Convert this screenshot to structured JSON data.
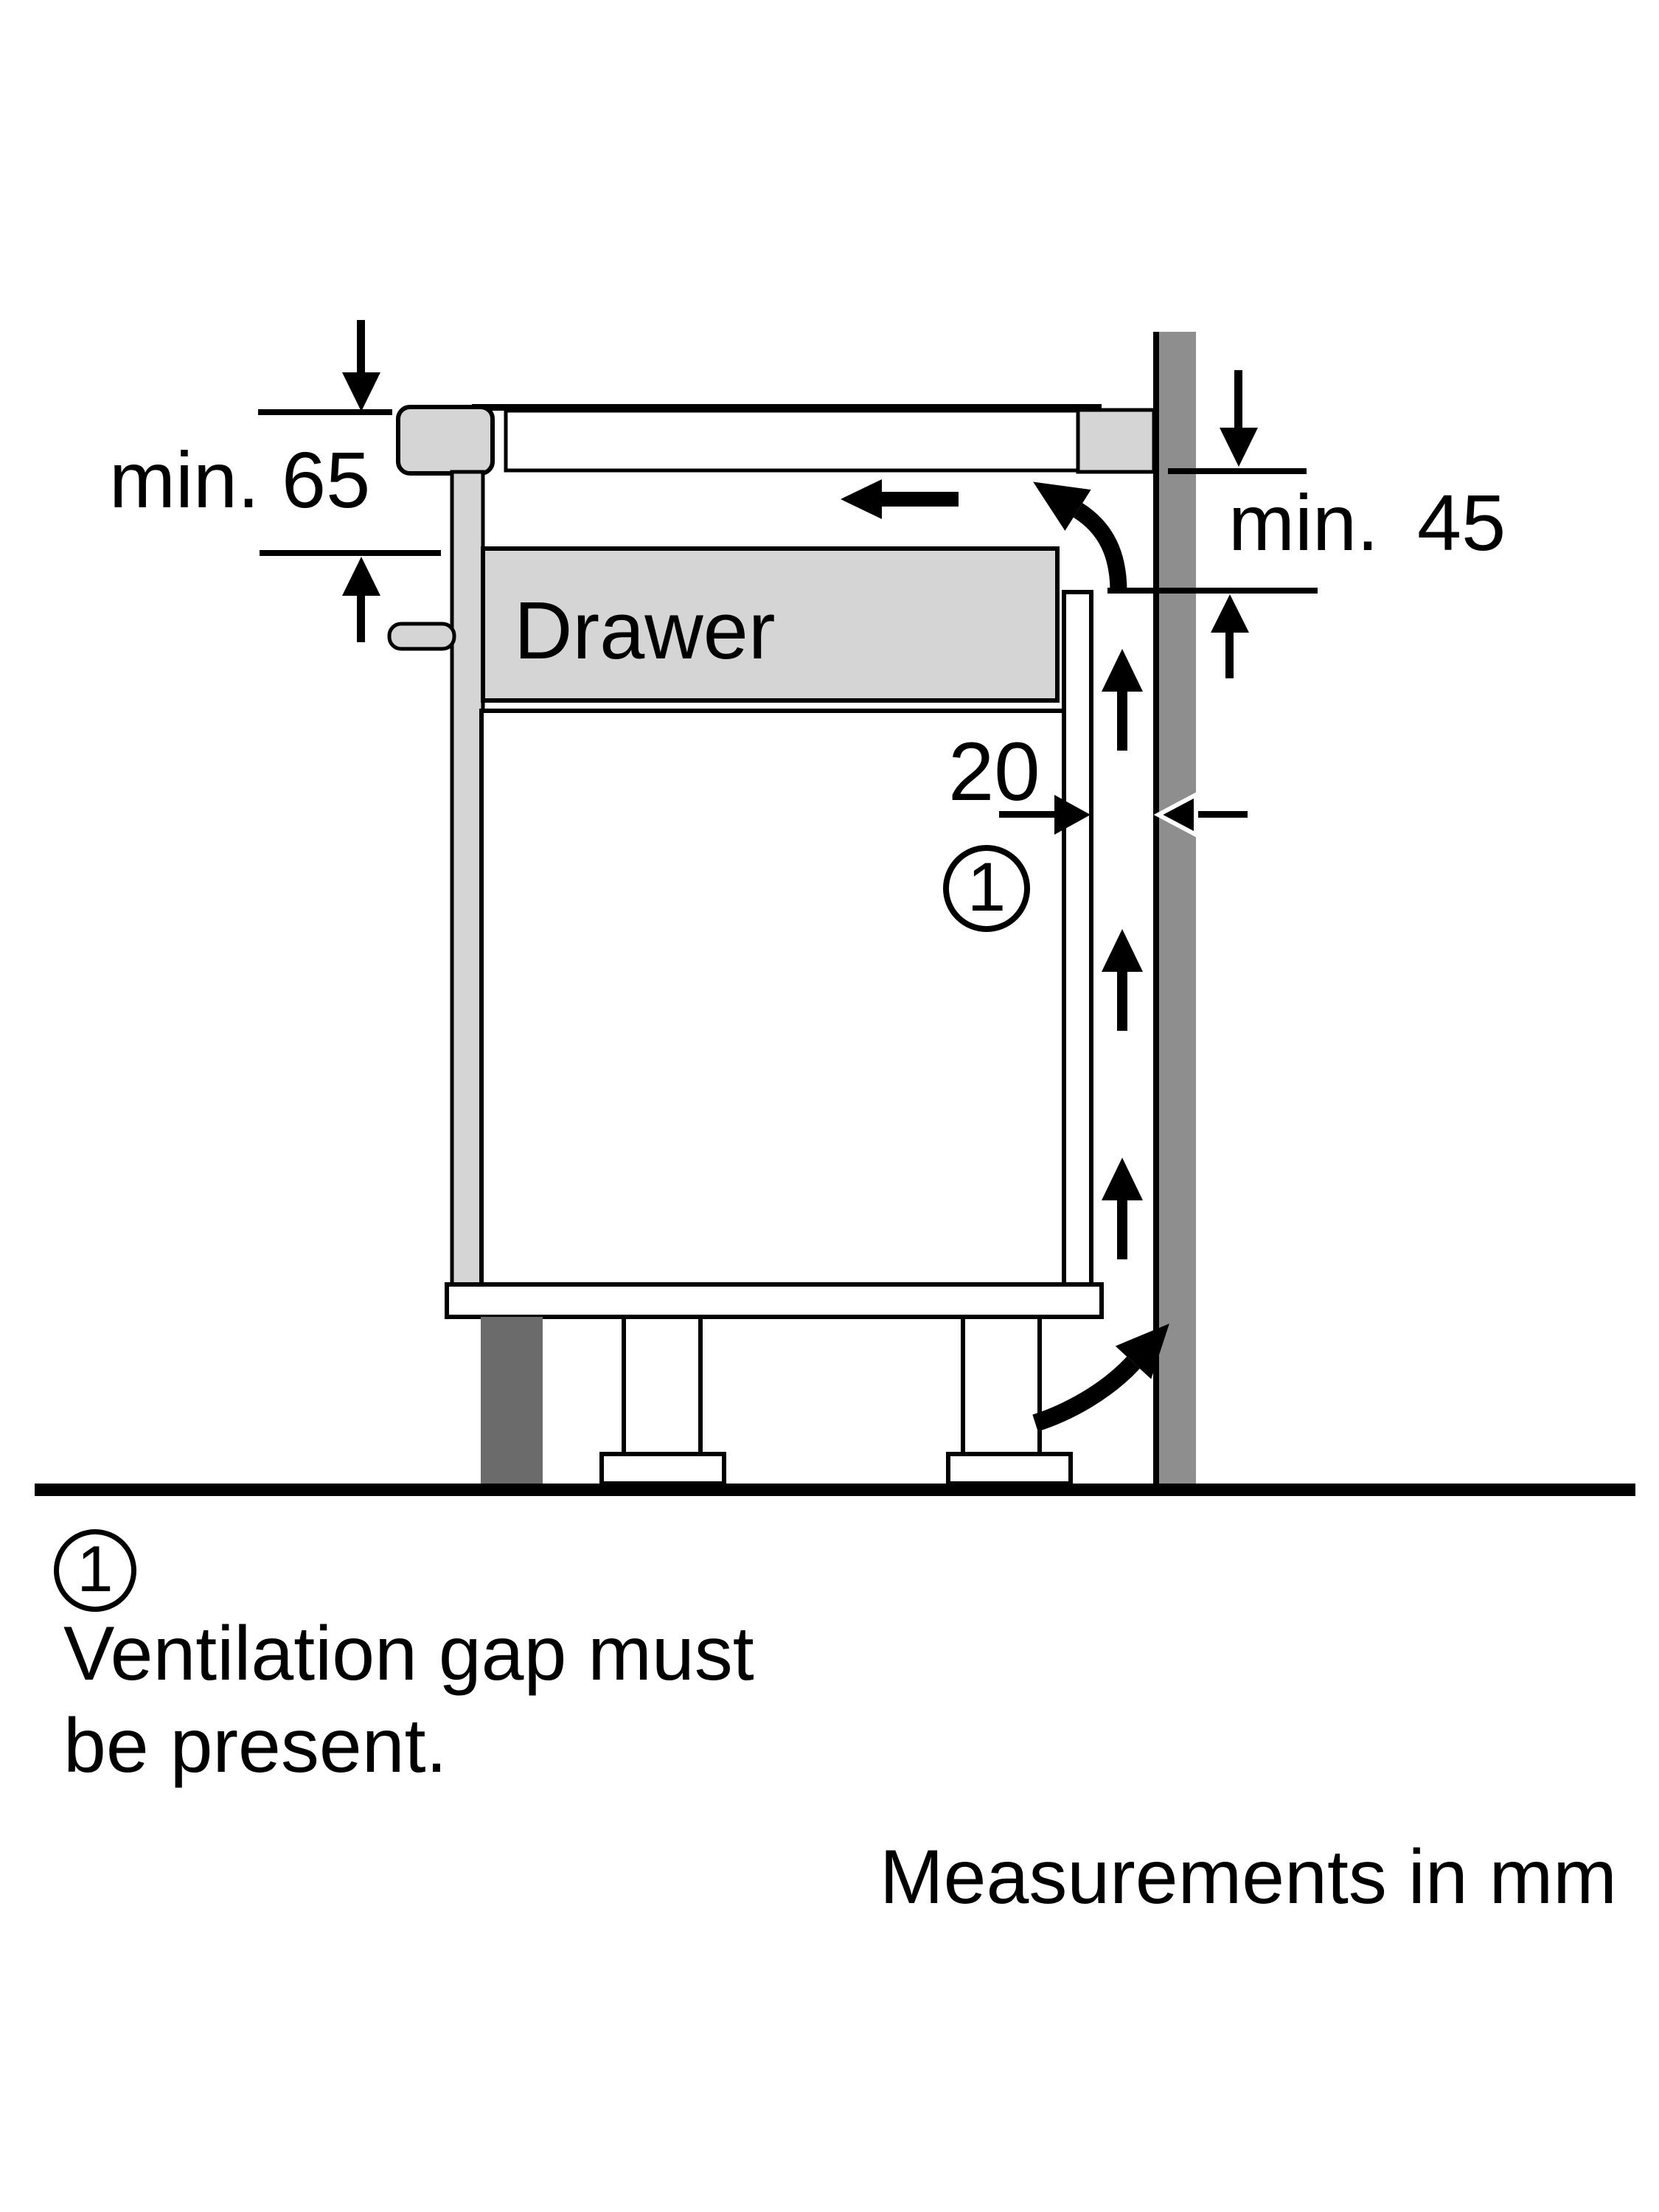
{
  "palette": {
    "line": "#000000",
    "light_gray": "#d5d5d5",
    "wall_gray": "#8e8e8e",
    "plinth_gray": "#6b6b6b",
    "background": "#ffffff"
  },
  "diagram": {
    "dim_left": "min. 65",
    "dim_right": "min. 45",
    "drawer_label": "Drawer",
    "gap_dim": "20",
    "callout_number": "1"
  },
  "legend": {
    "marker_number": "1",
    "line1": "Ventilation gap must",
    "line2": "be present.",
    "footnote": "Measurements in mm"
  }
}
